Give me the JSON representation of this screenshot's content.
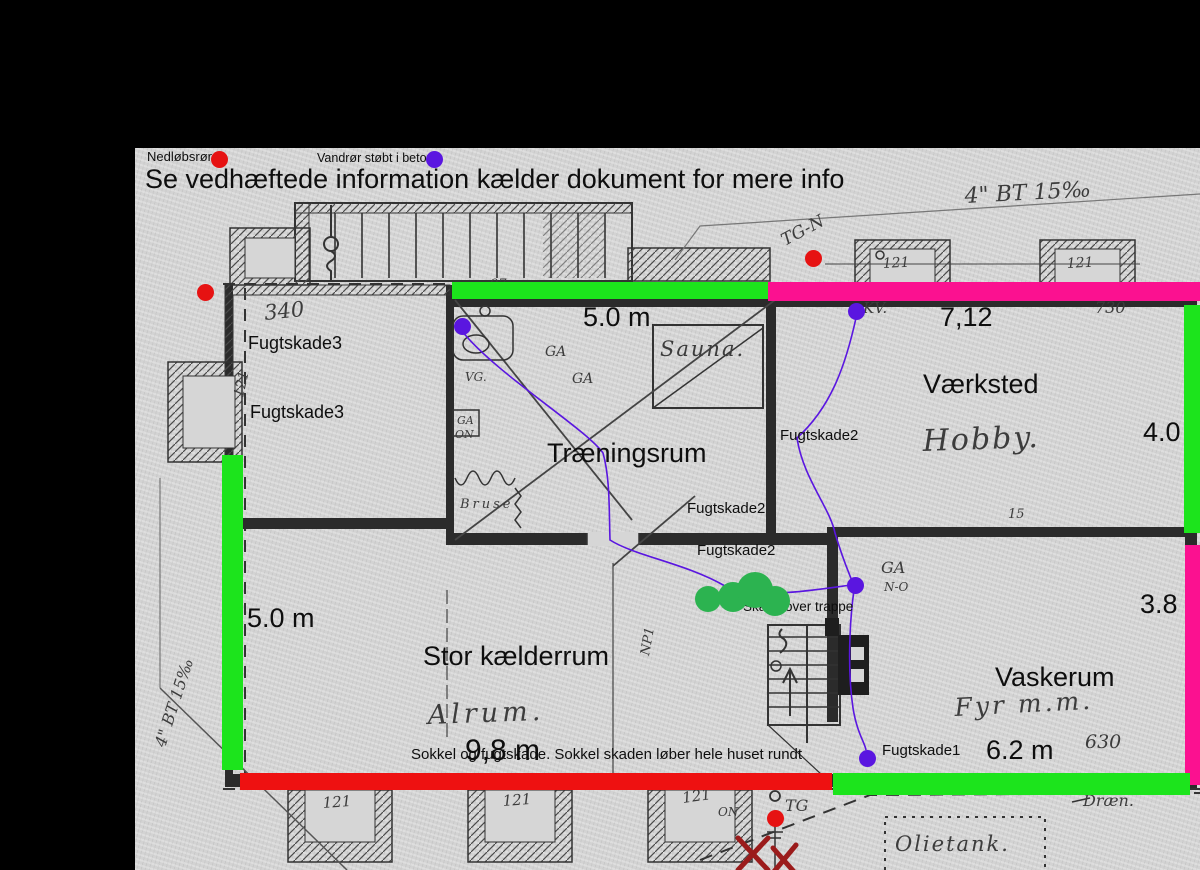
{
  "header": {
    "note": "Se vedhæftede information kælder dokument for mere info"
  },
  "legend": {
    "items": [
      {
        "label": "Nedløbsrør",
        "marker": "red-dot",
        "color": "#e61212"
      },
      {
        "label": "Vandrør støbt i beton",
        "marker": "purple-dot",
        "color": "#5a16e0"
      }
    ]
  },
  "rooms": {
    "traeningsrum": "Træningsrum",
    "vaerksted": "Værksted",
    "stor_kaelderrum": "Stor kælderrum",
    "vaskerum": "Vaskerum"
  },
  "measurements": {
    "top": "5.0 m",
    "vaerksted_width": "7,12",
    "right_upper": "4.0",
    "right_lower": "3.8",
    "left": "5.0 m",
    "bottom": "9,8 m",
    "vaskerum_width": "6.2 m"
  },
  "damage": {
    "f3": "Fugtskade3",
    "f2": "Fugtskade2",
    "f1": "Fugtskade1",
    "trappe": "Skade over trappe",
    "sokkel": "Sokkel og fugtskade. Sokkel skaden løber hele huset rundt"
  },
  "handwritten": {
    "bt_top": "4\" BT 15‰",
    "bt_left": "4\" BT 15‰",
    "tg_n": "TG-N",
    "kv": "KV.",
    "sauna": "Sauna.",
    "hobby": "Hobby.",
    "alrum": "Alrum.",
    "fyr": "Fyr m.m.",
    "olietank": "Olietank.",
    "draen": "Dræn.",
    "bruse": "Bruse",
    "ga": "GA",
    "vg": "VG.",
    "on": "ON",
    "n_o": "N-O",
    "tg": "TG",
    "np": "NP1",
    "n340": "340",
    "n730": "730",
    "n630": "630",
    "n121": "121",
    "n97": "97",
    "n15": "15"
  },
  "colors": {
    "bar_green": "#1ce41c",
    "bar_magenta": "#fb1190",
    "bar_red": "#ee1111",
    "dot_red": "#e61212",
    "dot_purple": "#5a16e0",
    "blob_green": "#2cb350"
  }
}
